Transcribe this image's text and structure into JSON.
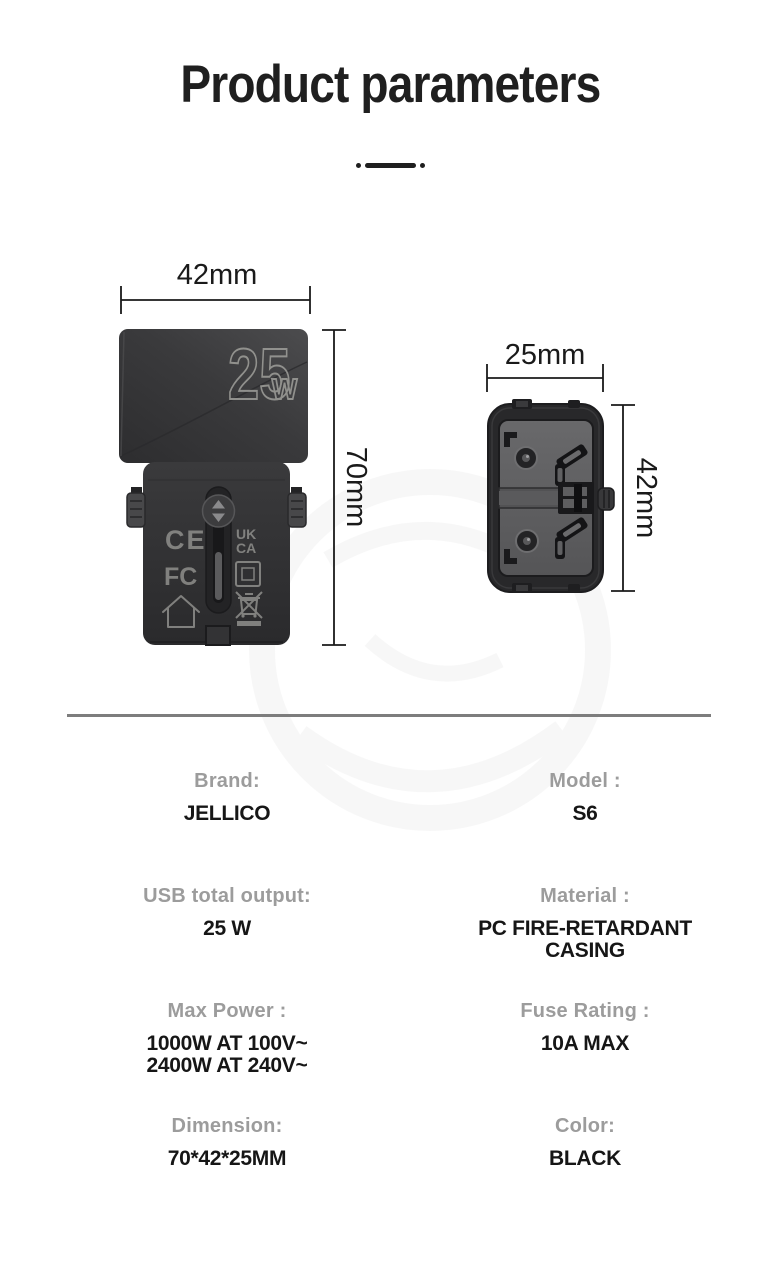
{
  "page_title": "Product parameters",
  "front_view": {
    "width_dim": "42mm",
    "height_dim": "70mm",
    "wattage_number": "25",
    "wattage_unit": "w",
    "markings": {
      "ce": "CE",
      "ukca_line1": "UK",
      "ukca_line2": "CA",
      "fcc": "FC"
    }
  },
  "side_view": {
    "width_dim": "25mm",
    "height_dim": "42mm"
  },
  "specs": [
    {
      "label": "Brand:",
      "value": "JELLICO"
    },
    {
      "label": "Model :",
      "value": "S6"
    },
    {
      "label": "USB total output:",
      "value": "25 W"
    },
    {
      "label": "Material :",
      "value": "PC FIRE-RETARDANT\nCASING"
    },
    {
      "label": "Max Power :",
      "value": "1000W AT 100V~\n2400W AT 240V~"
    },
    {
      "label": "Fuse Rating :",
      "value": "10A MAX"
    },
    {
      "label": "Dimension:",
      "value": "70*42*25MM"
    },
    {
      "label": "Color:",
      "value": "BLACK"
    }
  ],
  "colors": {
    "text_primary": "#1f1f1f",
    "label_gray": "#9c9c9c",
    "divider_gray": "#7d7d7d",
    "device_black": "#2e2e30"
  }
}
